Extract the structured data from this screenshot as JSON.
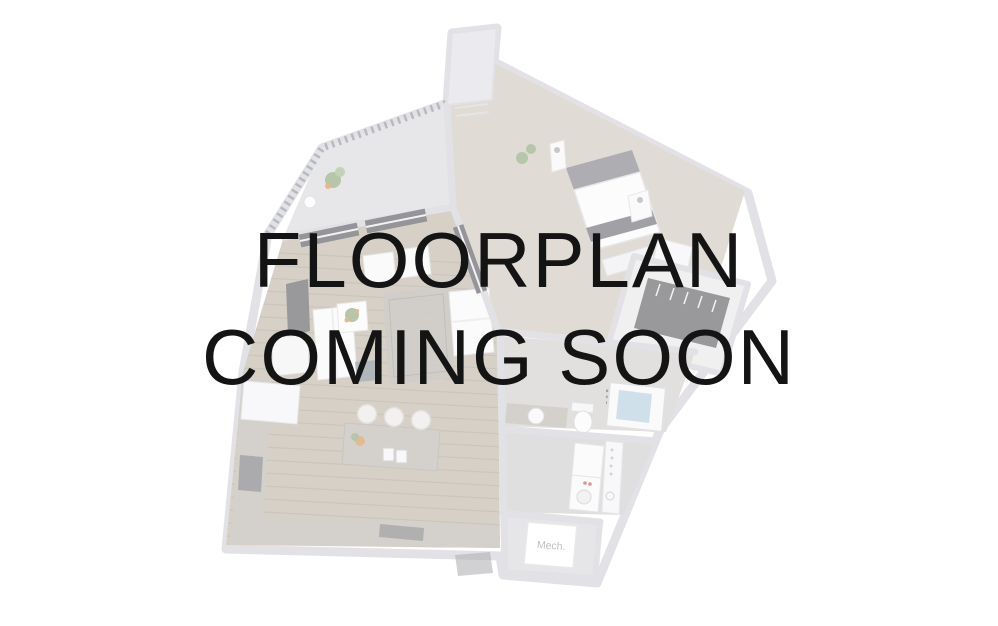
{
  "placeholder": {
    "line1": "FLOORPLAN",
    "line2": "COMING SOON",
    "text_color": "#141414"
  },
  "floorplan": {
    "mech_label": "Mech.",
    "render_opacity": "0.55",
    "colors": {
      "wall": "#cbcbd2",
      "wood_floor": "#b5ab9b",
      "bedroom_carpet": "#c8c1b3",
      "granite_counter": "#b2ada6",
      "dark_fixture": "#46464c",
      "plant_green": "#7d9668",
      "flower_orange": "#cf8030",
      "tub_water": "#a8c8da",
      "appliance_red": "#c04040",
      "mech_text": "#8a8a8a"
    }
  }
}
